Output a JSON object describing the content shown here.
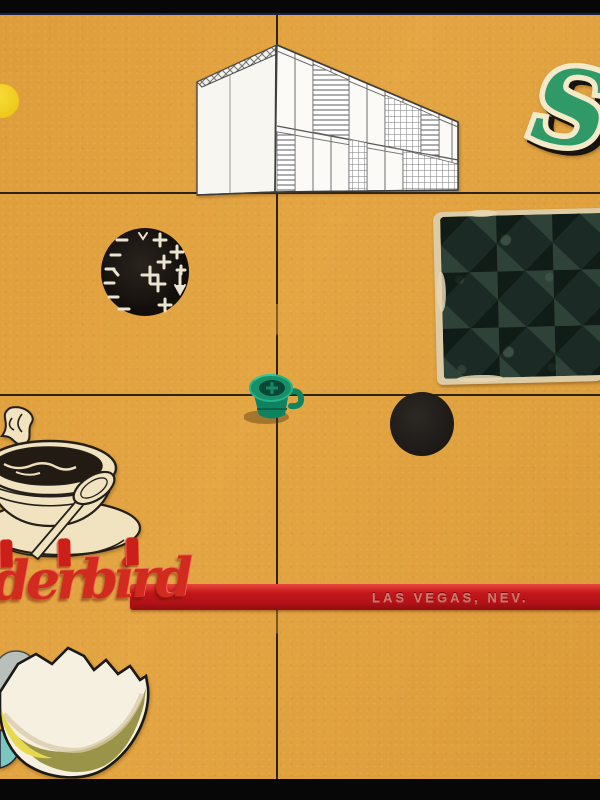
{
  "artwork": {
    "kind": "mixed-media collage on orange paperboard with hand-drawn grid",
    "board_color": "#e2a23e",
    "grid_color": "#2e2318",
    "scan_border_color": "#070707"
  },
  "swizzle": {
    "script_text": "derbird",
    "embossed_text": "LAS VEGAS, NEV.",
    "letters_color": "#d32a20",
    "stick_color": "#c3161b"
  },
  "elements": {
    "yellow_dot": {
      "name": "yellow-dot",
      "color": "#eec91a"
    },
    "house": {
      "name": "modernist-house-line-drawing"
    },
    "letter": {
      "name": "green-script-letter",
      "glyph": "S",
      "color": "#2f9a68"
    },
    "moon_stamp": {
      "name": "black-stamp-with-crosses"
    },
    "card": {
      "name": "worn-dark-patterned-card"
    },
    "cup": {
      "name": "green-plastic-toy-cup",
      "color": "#169068"
    },
    "black_dot": {
      "name": "black-dot",
      "color": "#1c1815"
    },
    "coffee": {
      "name": "vintage-coffee-cup-clipping"
    },
    "egg": {
      "name": "broken-eggshell-clipping"
    }
  }
}
